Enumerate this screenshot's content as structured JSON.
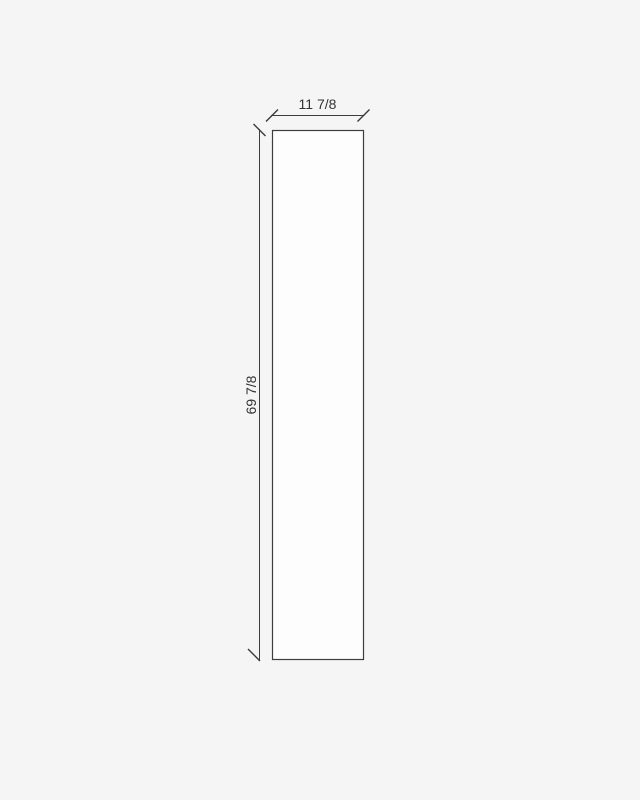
{
  "diagram": {
    "dimensions": {
      "width_label": "11 7/8",
      "height_label": "69 7/8"
    },
    "colors": {
      "background": "#f5f5f5",
      "panel_fill": "#fdfdfd",
      "line": "#3d3d3d",
      "text": "#333333"
    }
  }
}
